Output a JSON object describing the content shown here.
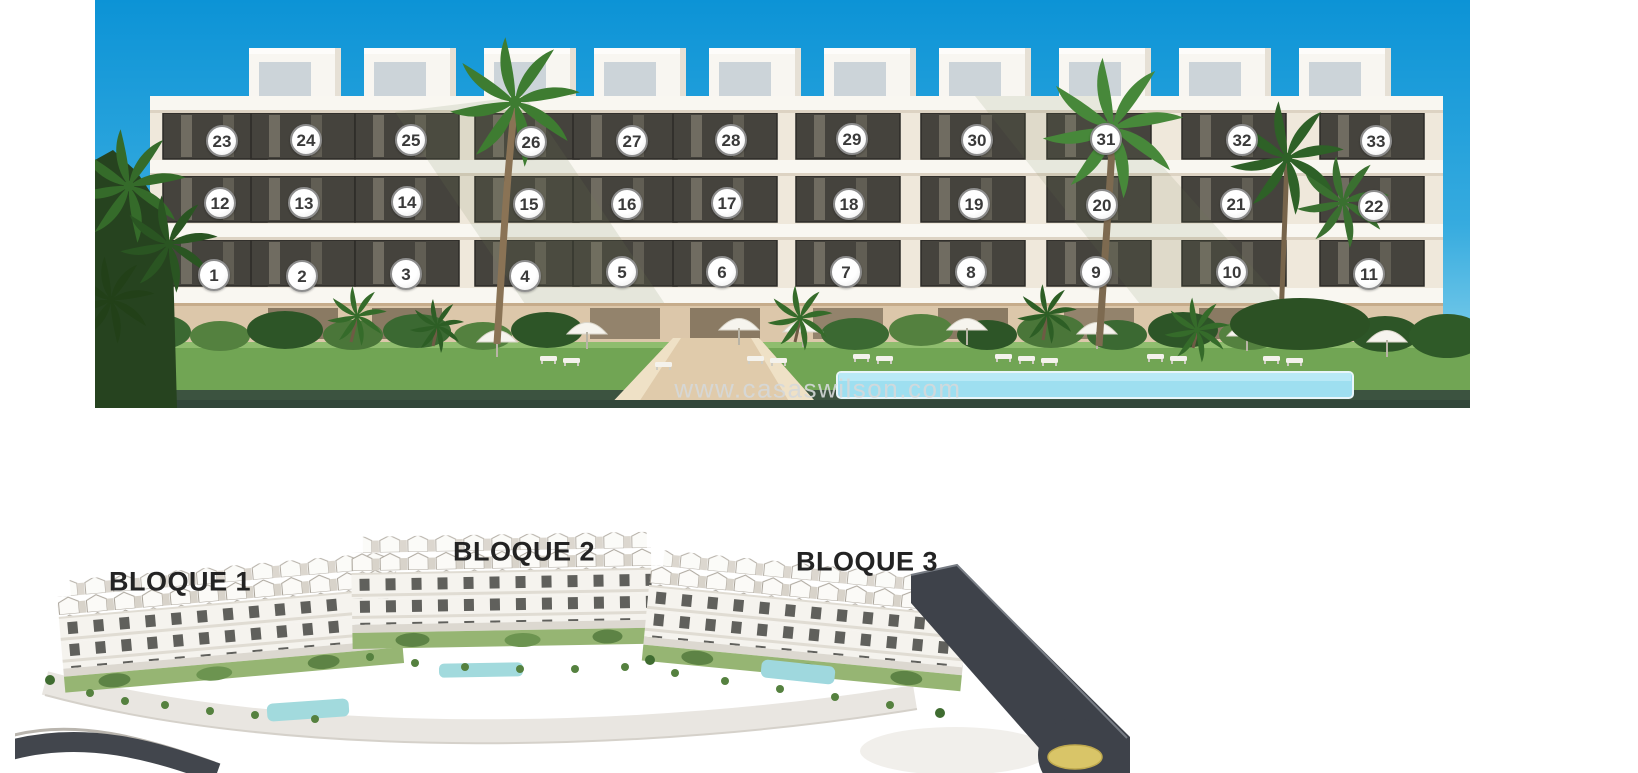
{
  "facade": {
    "description": "Front elevation render of apartment building with numbered units",
    "watermark": "www.casaswilson.com",
    "unit_markers": [
      {
        "label": "1",
        "x": 119,
        "y": 275
      },
      {
        "label": "2",
        "x": 207,
        "y": 276
      },
      {
        "label": "3",
        "x": 311,
        "y": 274
      },
      {
        "label": "4",
        "x": 430,
        "y": 276
      },
      {
        "label": "5",
        "x": 527,
        "y": 272
      },
      {
        "label": "6",
        "x": 627,
        "y": 272
      },
      {
        "label": "7",
        "x": 751,
        "y": 272
      },
      {
        "label": "8",
        "x": 876,
        "y": 272
      },
      {
        "label": "9",
        "x": 1001,
        "y": 272
      },
      {
        "label": "10",
        "x": 1137,
        "y": 272
      },
      {
        "label": "11",
        "x": 1274,
        "y": 274
      },
      {
        "label": "12",
        "x": 125,
        "y": 203
      },
      {
        "label": "13",
        "x": 209,
        "y": 203
      },
      {
        "label": "14",
        "x": 312,
        "y": 202
      },
      {
        "label": "15",
        "x": 434,
        "y": 204
      },
      {
        "label": "16",
        "x": 532,
        "y": 204
      },
      {
        "label": "17",
        "x": 632,
        "y": 203
      },
      {
        "label": "18",
        "x": 754,
        "y": 204
      },
      {
        "label": "19",
        "x": 879,
        "y": 204
      },
      {
        "label": "20",
        "x": 1007,
        "y": 205
      },
      {
        "label": "21",
        "x": 1141,
        "y": 204
      },
      {
        "label": "22",
        "x": 1279,
        "y": 206
      },
      {
        "label": "23",
        "x": 127,
        "y": 141
      },
      {
        "label": "24",
        "x": 211,
        "y": 140
      },
      {
        "label": "25",
        "x": 316,
        "y": 140
      },
      {
        "label": "26",
        "x": 436,
        "y": 142
      },
      {
        "label": "27",
        "x": 537,
        "y": 141
      },
      {
        "label": "28",
        "x": 636,
        "y": 140
      },
      {
        "label": "29",
        "x": 757,
        "y": 139
      },
      {
        "label": "30",
        "x": 882,
        "y": 140
      },
      {
        "label": "31",
        "x": 1011,
        "y": 139
      },
      {
        "label": "32",
        "x": 1147,
        "y": 140
      },
      {
        "label": "33",
        "x": 1281,
        "y": 141
      }
    ]
  },
  "siteplan": {
    "description": "Aerial render of development with three blocks and roundabout",
    "blocks": [
      {
        "label": "BLOQUE 1",
        "x": 165,
        "y": 77
      },
      {
        "label": "BLOQUE 2",
        "x": 509,
        "y": 47
      },
      {
        "label": "BLOQUE 3",
        "x": 852,
        "y": 57
      }
    ]
  },
  "palette": {
    "sky_top": "#0c93d6",
    "sky_horizon": "#9cdcef",
    "building_white": "#f8f5ef",
    "window_dark": "#45433d",
    "lawn": "#71a554",
    "pool": "#9edff0",
    "hedge_dark": "#3c5340",
    "road": "#3e424a",
    "roundabout_center": "#d9c568",
    "marker_border": "#8d8d8d",
    "marker_text": "#3a3a3a",
    "label_text": "#232323",
    "watermark_text": "#d5d8d9"
  }
}
